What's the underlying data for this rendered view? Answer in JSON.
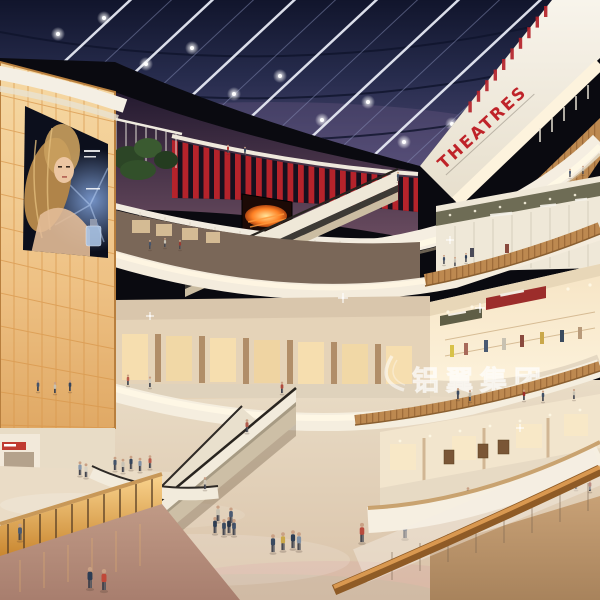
{
  "scene": {
    "description": "Architectural interior rendering of a curved multi-level shopping mall atrium in evening light: dark glass skylight grid with spotlights, red cinema signage, backlit amber panel wall with cosmetics billboard, criss-cross escalators, curved wooden balustrades and crowds of shoppers on a glossy stone floor.",
    "levels_visible": 5,
    "signs": {
      "theatre_sign": "THEATRES",
      "watermark_logo": "铝翼集团"
    },
    "palette": {
      "ceiling_navy": "#1a1f3c",
      "fascia_cream": "#f5eee1",
      "glow_warm": "#ffe9c2",
      "wood": "#c08b52",
      "amber_wall": "#eec184",
      "cinema_red": "#b5232b",
      "floor_beige": "#e2d3bc",
      "lower_floor_rose": "#b98d7c"
    }
  },
  "figures": [
    [
      228,
      153,
      0.36,
      "#b5302b"
    ],
    [
      245,
      155,
      0.36,
      "#3a4a62"
    ],
    [
      398,
      181,
      0.4,
      "#44546a"
    ],
    [
      570,
      177,
      0.36,
      "#50607a"
    ],
    [
      583,
      174,
      0.36,
      "#c8c2b4"
    ],
    [
      150,
      249,
      0.4,
      "#44546c"
    ],
    [
      165,
      247,
      0.4,
      "#c8c2b4"
    ],
    [
      180,
      249,
      0.4,
      "#9a3a30"
    ],
    [
      444,
      264,
      0.4,
      "#3f4f67"
    ],
    [
      455,
      266,
      0.4,
      "#c6c0b2"
    ],
    [
      466,
      262,
      0.4,
      "#2f3f57"
    ],
    [
      458,
      399,
      0.48,
      "#3a4a60"
    ],
    [
      470,
      401,
      0.48,
      "#b8b2a2"
    ],
    [
      524,
      400,
      0.46,
      "#9c2d2b"
    ],
    [
      543,
      401,
      0.46,
      "#3f4f65"
    ],
    [
      574,
      399,
      0.44,
      "#c8c2b2"
    ],
    [
      38,
      391,
      0.48,
      "#44546c"
    ],
    [
      55,
      393,
      0.48,
      "#c8c0b0"
    ],
    [
      70,
      391,
      0.48,
      "#35455b"
    ],
    [
      128,
      385,
      0.46,
      "#b85a4a"
    ],
    [
      150,
      387,
      0.46,
      "#d0cabc"
    ],
    [
      282,
      393,
      0.5,
      "#b04a3c"
    ],
    [
      468,
      500,
      0.56,
      "#3c4c64"
    ],
    [
      484,
      502,
      0.56,
      "#c04a3a"
    ],
    [
      501,
      498,
      0.56,
      "#d8d2c2"
    ],
    [
      517,
      500,
      0.56,
      "#2c3c52"
    ],
    [
      560,
      492,
      0.52,
      "#cabfae"
    ],
    [
      576,
      489,
      0.52,
      "#2f3f55"
    ],
    [
      590,
      491,
      0.5,
      "#8a3a30"
    ],
    [
      247,
      432,
      0.56,
      "#b05a4a"
    ],
    [
      152,
      498,
      0.58,
      "#50607a"
    ],
    [
      205,
      489,
      0.52,
      "#d0c8b8"
    ],
    [
      80,
      475,
      0.6,
      "#8898ac"
    ],
    [
      86,
      477,
      0.6,
      "#d8d2c4"
    ],
    [
      115,
      470,
      0.58,
      "#44546a"
    ],
    [
      123,
      472,
      0.58,
      "#c8c2b4"
    ],
    [
      131,
      469,
      0.58,
      "#35455c"
    ],
    [
      140,
      471,
      0.58,
      "#8090a4"
    ],
    [
      150,
      468,
      0.56,
      "#b85a4a"
    ],
    [
      52,
      538,
      0.74,
      "#caa84a"
    ],
    [
      63,
      540,
      0.74,
      "#b84a3c"
    ],
    [
      127,
      553,
      0.8,
      "#7a8aa0"
    ],
    [
      134,
      551,
      0.8,
      "#e8e4da"
    ],
    [
      153,
      552,
      0.8,
      "#5a6a50"
    ],
    [
      161,
      550,
      0.8,
      "#3b4a62"
    ],
    [
      185,
      580,
      0.86,
      "#8a2f2a"
    ],
    [
      201,
      578,
      0.86,
      "#46566e"
    ],
    [
      215,
      533,
      0.7,
      "#2e3e54"
    ],
    [
      224,
      535,
      0.7,
      "#3a4a60"
    ],
    [
      229,
      533,
      0.7,
      "#25354b"
    ],
    [
      234,
      535,
      0.7,
      "#42526a"
    ],
    [
      218,
      521,
      0.68,
      "#c8c2b2"
    ],
    [
      231,
      523,
      0.68,
      "#4a5a72"
    ],
    [
      273,
      552,
      0.78,
      "#3a4a60"
    ],
    [
      283,
      550,
      0.78,
      "#caa84a"
    ],
    [
      293,
      548,
      0.78,
      "#2e3e54"
    ],
    [
      299,
      550,
      0.78,
      "#8090a4"
    ],
    [
      362,
      542,
      0.84,
      "#b84a3c"
    ],
    [
      405,
      538,
      0.84,
      "#3f4e66"
    ],
    [
      20,
      540,
      0.72,
      "#4a5a72",
      "front"
    ],
    [
      90,
      588,
      0.92,
      "#2c3c54",
      "front"
    ],
    [
      104,
      590,
      0.92,
      "#c04838",
      "front"
    ]
  ]
}
